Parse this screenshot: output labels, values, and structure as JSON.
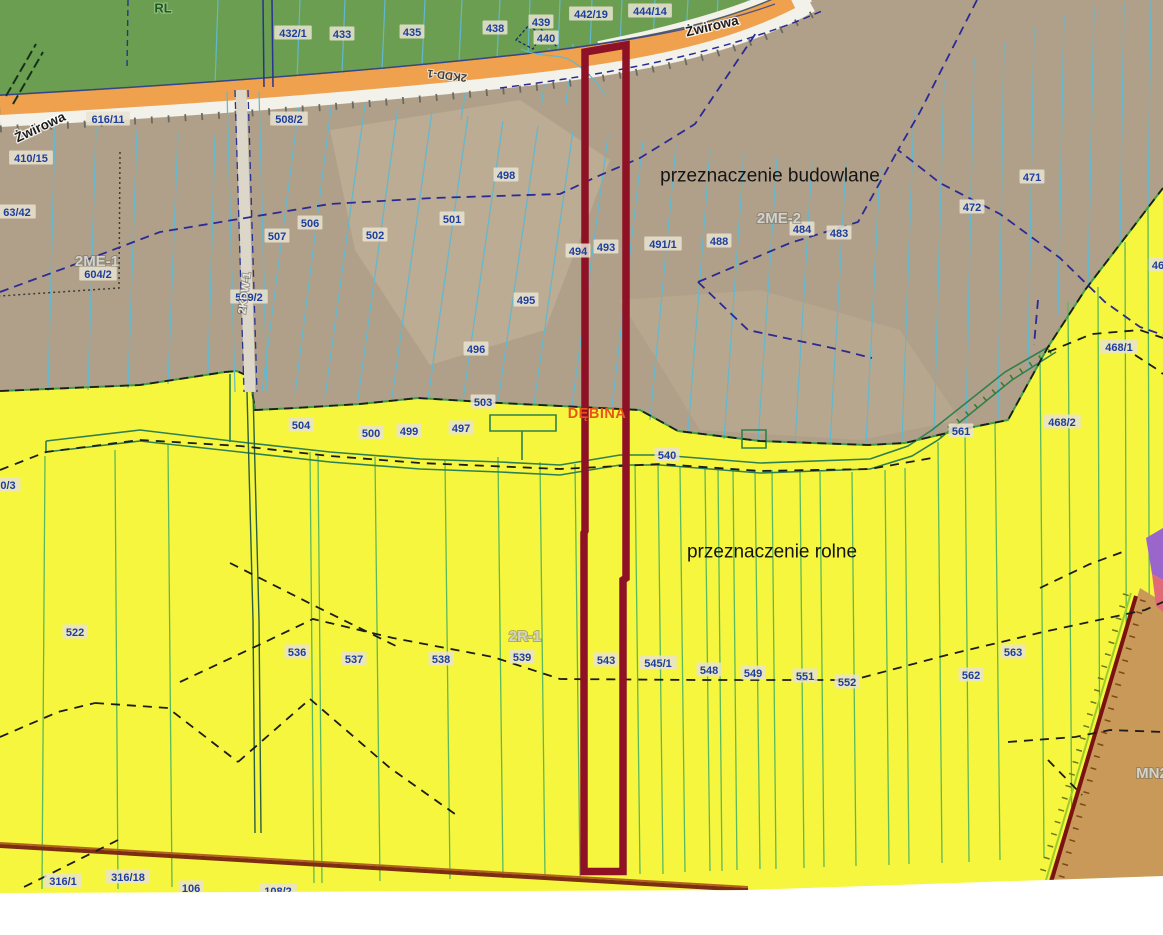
{
  "map": {
    "zones": {
      "forest_code": "RL",
      "budowlane_label": "przeznaczenie budowlane",
      "rolne_label": "przeznaczenie rolne",
      "codes": [
        "2ME-1",
        "2ME-2",
        "2R-1",
        "MN2",
        "RL"
      ]
    },
    "streets": [
      "Żwirowa"
    ],
    "road_codes": [
      "2KDD-1",
      "2KDW-1"
    ],
    "locality": "DĘBINA",
    "colors": {
      "forest_fill": "#6b9e51",
      "budowlane_fill": "#b1a089",
      "rolne_fill": "#f6f63e",
      "mn2_fill": "#c9995a",
      "road_fill": "#efa14e",
      "road_shoulder": "#f2f1ea",
      "highlight_outline": "#8e1126",
      "parcel_line_tan": "#62b8cf",
      "parcel_line_yellow": "#5cb85c",
      "plan_boundary_dash": "#2a2a96",
      "field_boundary_dash": "#1c1c1c",
      "zone_boundary_green": "#3f9c46",
      "parcel_text": "#1e3e9e",
      "locality_text": "#e8561c",
      "area_text": "#141414",
      "purple_patch": "#9a66cc",
      "pink_patch": "#e06a78"
    },
    "labels": [
      {
        "text": "RL",
        "x": 163,
        "y": 8,
        "kind": "forestcode"
      },
      {
        "text": "616/11",
        "x": 108,
        "y": 119,
        "kind": "parcel"
      },
      {
        "text": "410/15",
        "x": 31,
        "y": 158,
        "kind": "parcel"
      },
      {
        "text": "432/1",
        "x": 293,
        "y": 33,
        "kind": "parcel"
      },
      {
        "text": "433",
        "x": 342,
        "y": 34,
        "kind": "parcel"
      },
      {
        "text": "435",
        "x": 412,
        "y": 32,
        "kind": "parcel"
      },
      {
        "text": "438",
        "x": 495,
        "y": 28,
        "kind": "parcel"
      },
      {
        "text": "439",
        "x": 541,
        "y": 22,
        "kind": "parcel"
      },
      {
        "text": "440",
        "x": 546,
        "y": 38,
        "kind": "parcel"
      },
      {
        "text": "442/19",
        "x": 591,
        "y": 14,
        "kind": "parcel"
      },
      {
        "text": "444/14",
        "x": 650,
        "y": 11,
        "kind": "parcel"
      },
      {
        "text": "508/2",
        "x": 289,
        "y": 119,
        "kind": "parcel"
      },
      {
        "text": "Żwirowa",
        "x": 40,
        "y": 127,
        "kind": "street",
        "rot": -25
      },
      {
        "text": "Żwirowa",
        "x": 712,
        "y": 26,
        "kind": "street",
        "rot": -13
      },
      {
        "text": "2KDD-1",
        "x": 447,
        "y": 76,
        "kind": "roadcode",
        "rot": 187
      },
      {
        "text": "63/42",
        "x": 17,
        "y": 212,
        "kind": "parcel"
      },
      {
        "text": "2ME-1",
        "x": 97,
        "y": 261,
        "kind": "zonecode"
      },
      {
        "text": "604/2",
        "x": 98,
        "y": 274,
        "kind": "parcel"
      },
      {
        "text": "506",
        "x": 310,
        "y": 223,
        "kind": "parcel"
      },
      {
        "text": "507",
        "x": 277,
        "y": 236,
        "kind": "parcel"
      },
      {
        "text": "502",
        "x": 375,
        "y": 235,
        "kind": "parcel"
      },
      {
        "text": "501",
        "x": 452,
        "y": 219,
        "kind": "parcel"
      },
      {
        "text": "498",
        "x": 506,
        "y": 175,
        "kind": "parcel"
      },
      {
        "text": "509/2",
        "x": 249,
        "y": 297,
        "kind": "parcel"
      },
      {
        "text": "2KDW-1",
        "x": 244,
        "y": 293,
        "kind": "roadcode-light",
        "rot": -83
      },
      {
        "text": "494",
        "x": 578,
        "y": 251,
        "kind": "parcel"
      },
      {
        "text": "493",
        "x": 606,
        "y": 247,
        "kind": "parcel"
      },
      {
        "text": "491/1",
        "x": 663,
        "y": 244,
        "kind": "parcel"
      },
      {
        "text": "488",
        "x": 719,
        "y": 241,
        "kind": "parcel"
      },
      {
        "text": "484",
        "x": 802,
        "y": 229,
        "kind": "parcel"
      },
      {
        "text": "483",
        "x": 839,
        "y": 233,
        "kind": "parcel"
      },
      {
        "text": "2ME-2",
        "x": 779,
        "y": 218,
        "kind": "zonecode"
      },
      {
        "text": "471",
        "x": 1032,
        "y": 177,
        "kind": "parcel"
      },
      {
        "text": "472",
        "x": 972,
        "y": 207,
        "kind": "parcel"
      },
      {
        "text": "495",
        "x": 526,
        "y": 300,
        "kind": "parcel"
      },
      {
        "text": "496",
        "x": 476,
        "y": 349,
        "kind": "parcel"
      },
      {
        "text": "przeznaczenie budowlane",
        "x": 770,
        "y": 175,
        "kind": "area"
      },
      {
        "text": "503",
        "x": 483,
        "y": 402,
        "kind": "parcel"
      },
      {
        "text": "504",
        "x": 301,
        "y": 425,
        "kind": "parcel"
      },
      {
        "text": "500",
        "x": 371,
        "y": 433,
        "kind": "parcel"
      },
      {
        "text": "499",
        "x": 409,
        "y": 431,
        "kind": "parcel"
      },
      {
        "text": "497",
        "x": 461,
        "y": 428,
        "kind": "parcel"
      },
      {
        "text": "DĘBINA",
        "x": 597,
        "y": 413,
        "kind": "locality"
      },
      {
        "text": "540",
        "x": 667,
        "y": 455,
        "kind": "parcel"
      },
      {
        "text": "561",
        "x": 961,
        "y": 431,
        "kind": "parcel"
      },
      {
        "text": "468/2",
        "x": 1062,
        "y": 422,
        "kind": "parcel"
      },
      {
        "text": "468/1",
        "x": 1119,
        "y": 347,
        "kind": "parcel"
      },
      {
        "text": "46",
        "x": 1158,
        "y": 265,
        "kind": "parcel"
      },
      {
        "text": "0/3",
        "x": 8,
        "y": 485,
        "kind": "parcel"
      },
      {
        "text": "przeznaczenie rolne",
        "x": 772,
        "y": 551,
        "kind": "area"
      },
      {
        "text": "2R-1",
        "x": 525,
        "y": 636,
        "kind": "zonecode"
      },
      {
        "text": "522",
        "x": 75,
        "y": 632,
        "kind": "parcel"
      },
      {
        "text": "536",
        "x": 297,
        "y": 652,
        "kind": "parcel"
      },
      {
        "text": "537",
        "x": 354,
        "y": 659,
        "kind": "parcel"
      },
      {
        "text": "538",
        "x": 441,
        "y": 659,
        "kind": "parcel"
      },
      {
        "text": "539",
        "x": 522,
        "y": 657,
        "kind": "parcel"
      },
      {
        "text": "543",
        "x": 606,
        "y": 660,
        "kind": "parcel"
      },
      {
        "text": "545/1",
        "x": 658,
        "y": 663,
        "kind": "parcel"
      },
      {
        "text": "548",
        "x": 709,
        "y": 670,
        "kind": "parcel"
      },
      {
        "text": "549",
        "x": 753,
        "y": 673,
        "kind": "parcel"
      },
      {
        "text": "551",
        "x": 805,
        "y": 676,
        "kind": "parcel"
      },
      {
        "text": "552",
        "x": 847,
        "y": 682,
        "kind": "parcel"
      },
      {
        "text": "563",
        "x": 1013,
        "y": 652,
        "kind": "parcel"
      },
      {
        "text": "562",
        "x": 971,
        "y": 675,
        "kind": "parcel"
      },
      {
        "text": "MN2",
        "x": 1152,
        "y": 773,
        "kind": "zonecode"
      },
      {
        "text": "316/1",
        "x": 63,
        "y": 881,
        "kind": "parcel"
      },
      {
        "text": "316/18",
        "x": 128,
        "y": 877,
        "kind": "parcel"
      },
      {
        "text": "106",
        "x": 191,
        "y": 888,
        "kind": "parcel"
      },
      {
        "text": "108/2",
        "x": 278,
        "y": 891,
        "kind": "parcel"
      }
    ]
  }
}
